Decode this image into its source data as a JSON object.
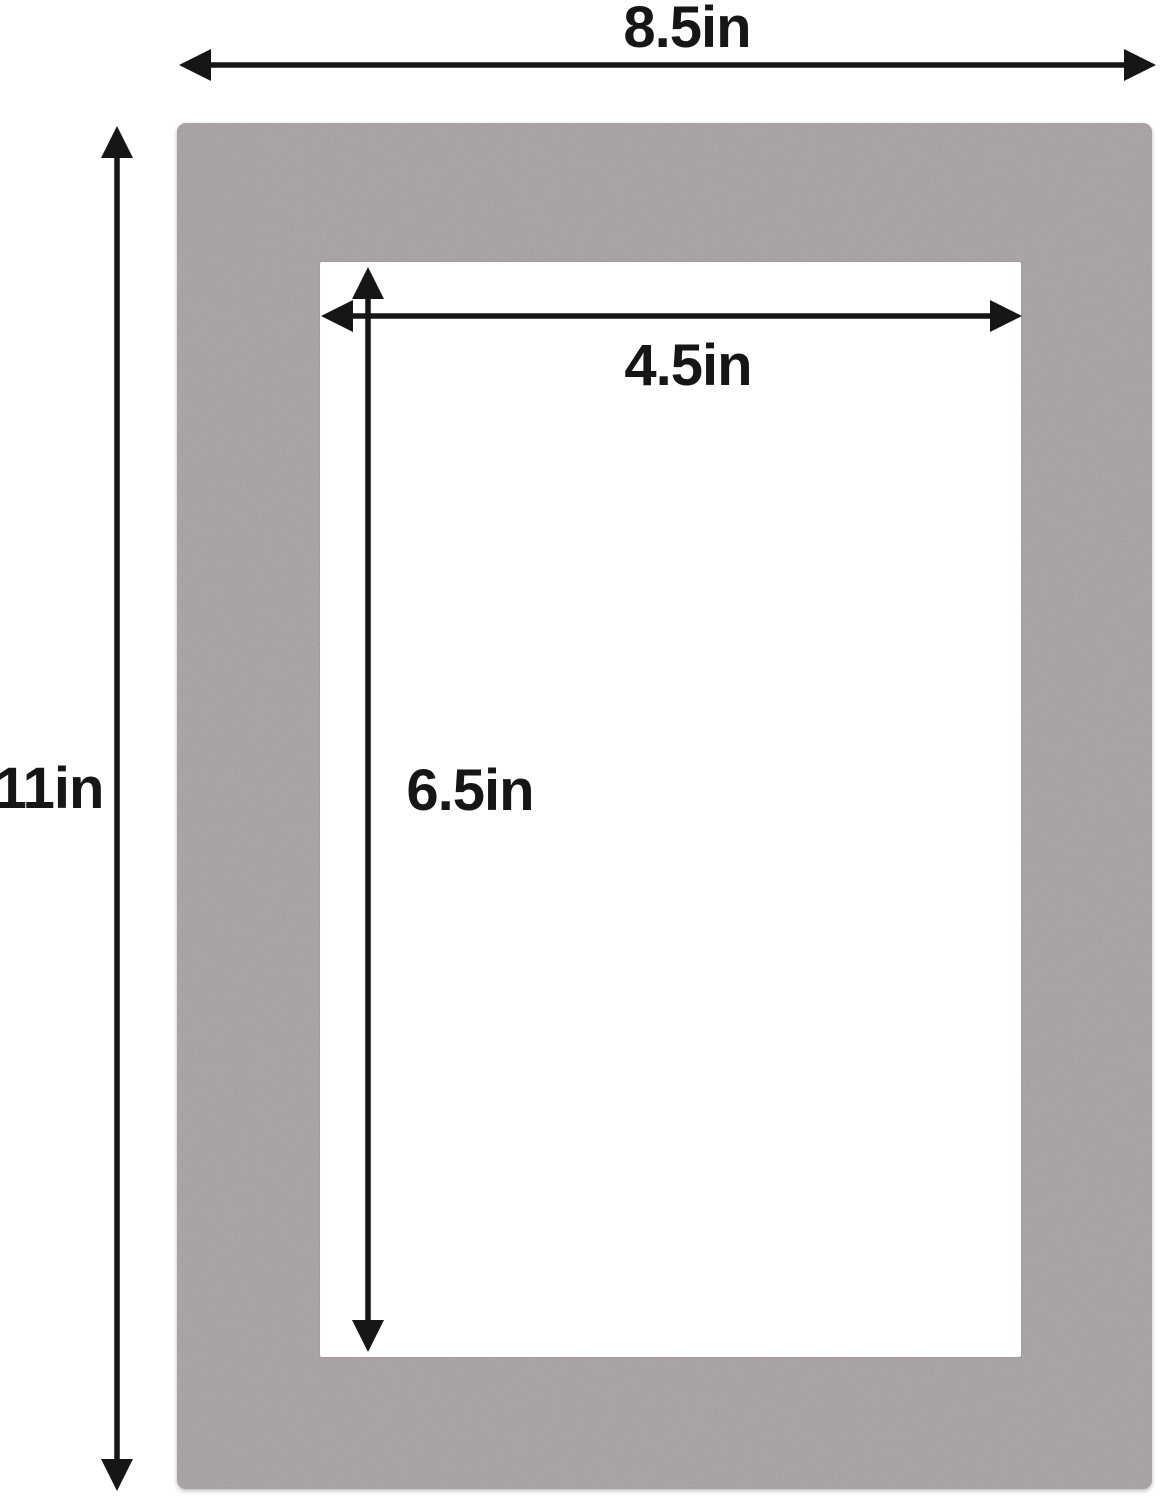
{
  "diagram": {
    "description": "Gray picture-frame mat board with rectangular cut opening, annotated with dimension arrows",
    "colors": {
      "background": "#ffffff",
      "mat": "#a8a1a4",
      "opening": "#ffffff",
      "annotation": "#161616"
    },
    "measurements": {
      "outer_width": {
        "label": "8.5in"
      },
      "outer_height": {
        "label": "11in"
      },
      "opening_width": {
        "label": "4.5in"
      },
      "opening_height": {
        "label": "6.5in"
      }
    }
  }
}
